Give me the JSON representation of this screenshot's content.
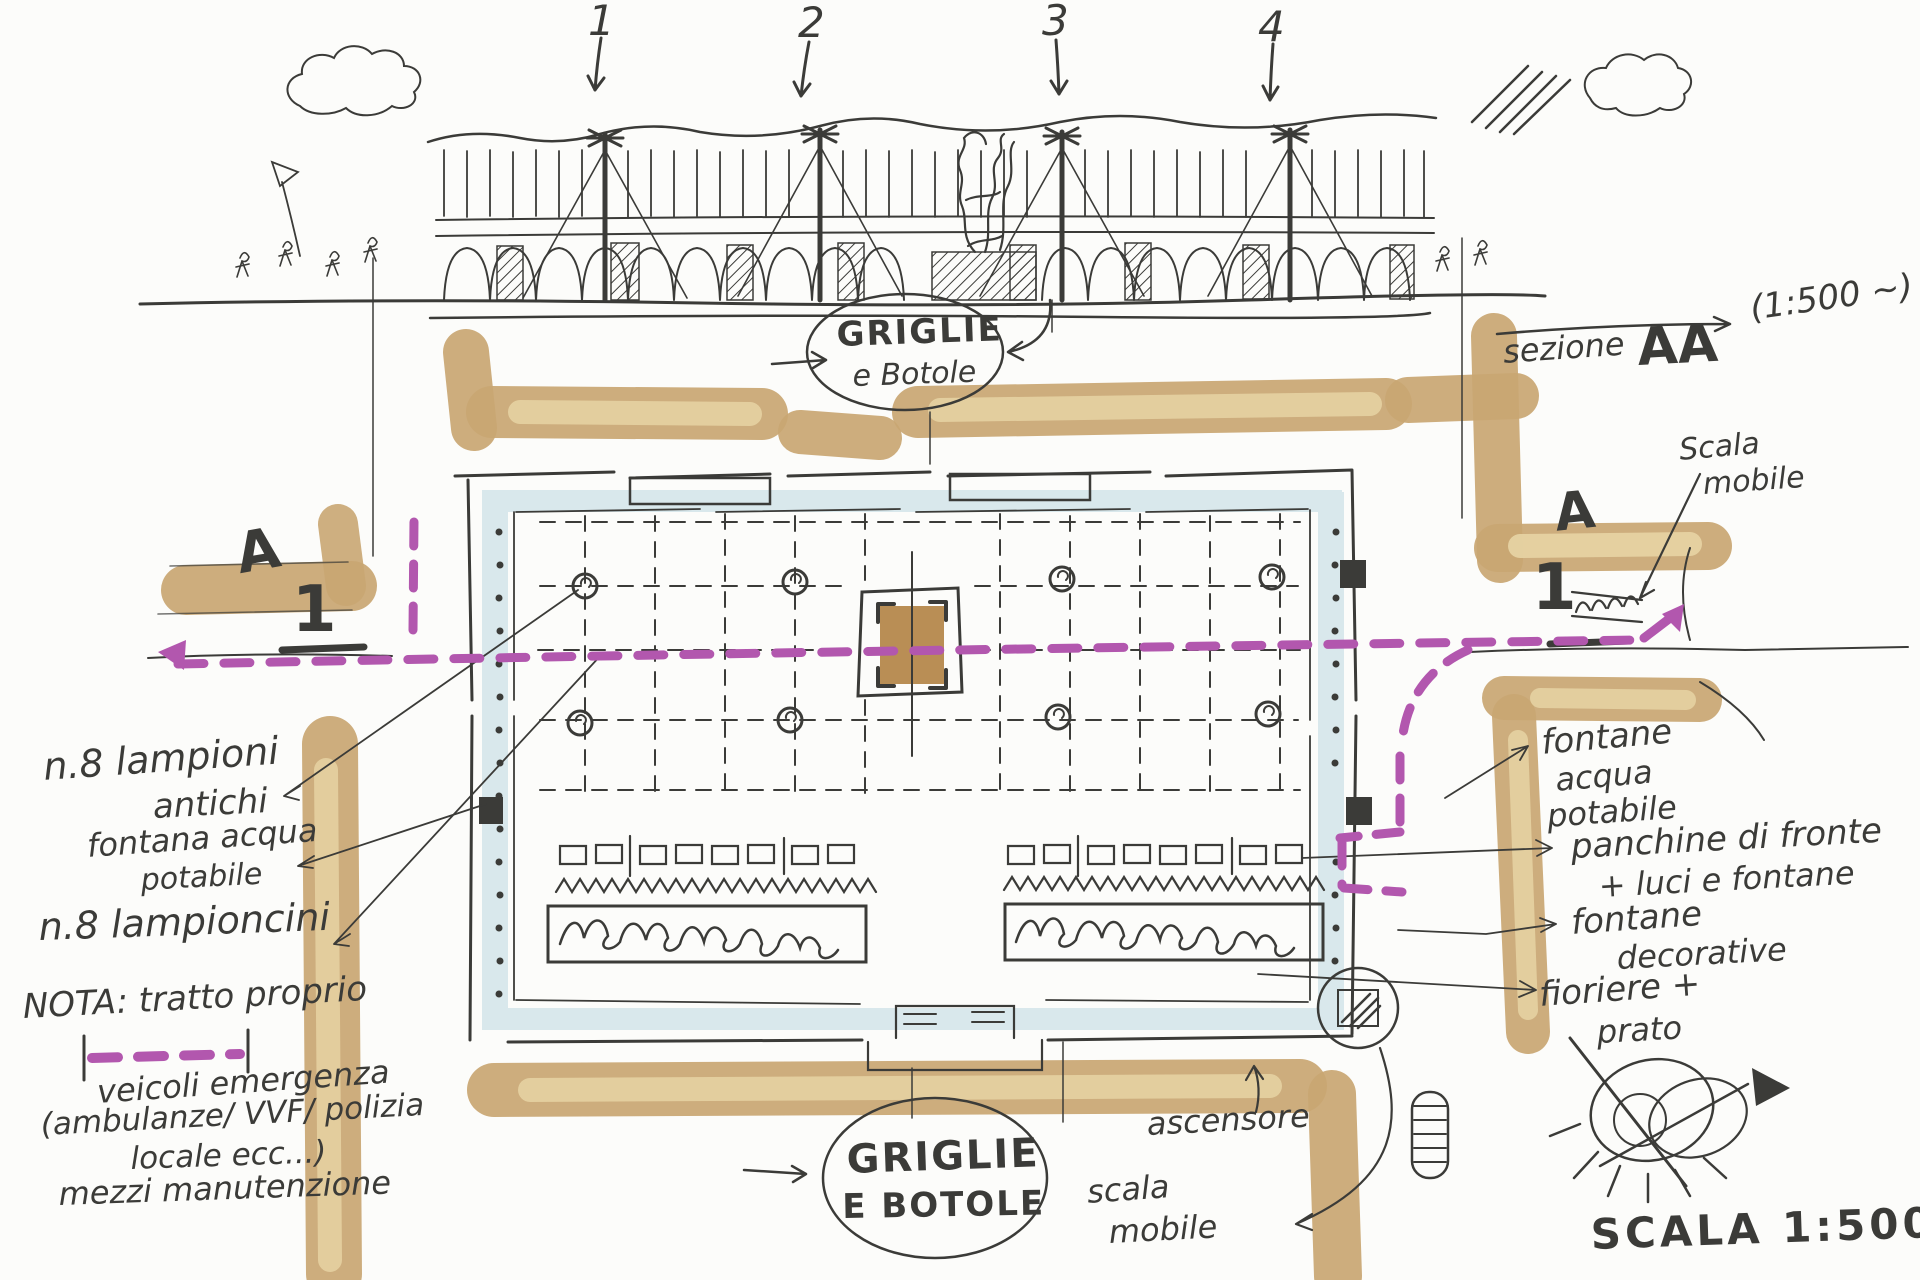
{
  "colors": {
    "ink": "#3b3b38",
    "street_marker": "#c9a672",
    "street_marker_light": "#e6d2a2",
    "route_dashed": "#b257ae",
    "plaza_edge_band": "#d9e8ec",
    "monument_fill": "#b98e55"
  },
  "elevation": {
    "callouts": [
      "1",
      "2",
      "3",
      "4"
    ]
  },
  "top_ellipse": {
    "line1": "GRIGLIE",
    "line2": "e Botole"
  },
  "bottom_ellipse": {
    "line1": "GRIGLIE",
    "line2": "E BOTOLE"
  },
  "section": {
    "label": "sezione",
    "name": "AA",
    "scale": "(1:500 ~)"
  },
  "markers": {
    "letter": "A",
    "number": "1"
  },
  "plan_scale": "SCALA 1:500 ~",
  "labels": {
    "scala_mobile_top_1": "Scala",
    "scala_mobile_top_2": "mobile",
    "ascensore": "ascensore",
    "scala_mobile_bottom_1": "scala",
    "scala_mobile_bottom_2": "mobile"
  },
  "notes_left": {
    "lampioni_1": "n.8 lampioni",
    "lampioni_2": "antichi",
    "fontana_1": "fontana acqua",
    "fontana_2": "potabile",
    "lampioncini": "n.8 lampioncini"
  },
  "nota": {
    "line1": "NOTA: tratto proprio",
    "line2": "veicoli emergenza",
    "line3": "(ambulanze/ VVF/ polizia",
    "line4": "locale ecc...)",
    "line5": "mezzi manutenzione"
  },
  "notes_right": {
    "fontane_1": "fontane",
    "fontane_2": "acqua",
    "fontane_3": "potabile",
    "panchine_1": "panchine di fronte",
    "panchine_2": "+ luci e fontane",
    "decorative_1": "fontane",
    "decorative_2": "decorative",
    "fioriere_1": "fioriere +",
    "fioriere_2": "prato"
  }
}
